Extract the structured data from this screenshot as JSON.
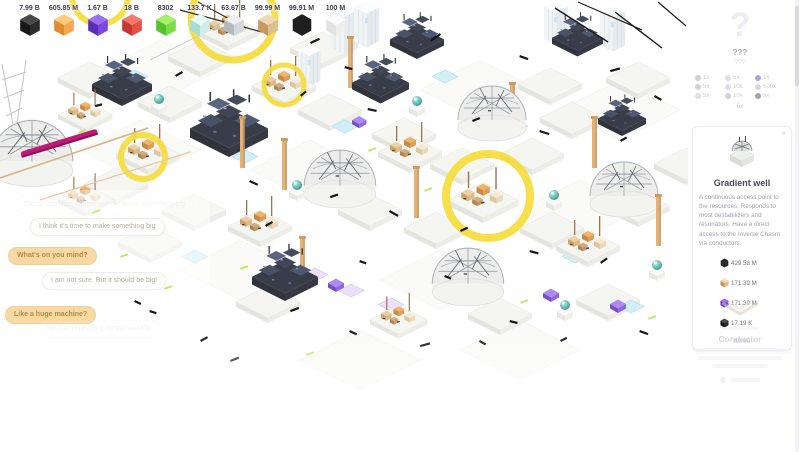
{
  "top_bar": {
    "resources": [
      {
        "name": "black-cube",
        "type": "cube",
        "colors": [
          "#4a4a4a",
          "#181818",
          "#2c2c2c"
        ],
        "value": "7.99 B"
      },
      {
        "name": "orange-cube",
        "type": "cube",
        "colors": [
          "#ffc97e",
          "#e08c2e",
          "#f4a84b"
        ],
        "value": "605.85 M"
      },
      {
        "name": "purple-cube",
        "type": "cube",
        "colors": [
          "#9a6ff5",
          "#5c2eb8",
          "#7a48dd"
        ],
        "value": "1.67 B"
      },
      {
        "name": "red-cube",
        "type": "cube",
        "colors": [
          "#f47a70",
          "#c73832",
          "#e25048"
        ],
        "value": "18 B"
      },
      {
        "name": "green-cube",
        "type": "cube",
        "colors": [
          "#a5f06a",
          "#55c22c",
          "#7cdc48"
        ],
        "value": "8302"
      },
      {
        "name": "prism-cube",
        "type": "cube",
        "colors": [
          "#eafaf7",
          "#a8ded6",
          "#cdeee9"
        ],
        "value": "133.7 K"
      },
      {
        "name": "silver-cube",
        "type": "cube",
        "colors": [
          "#eef0f2",
          "#b4bac0",
          "#d3d7db"
        ],
        "value": "63.67 B"
      },
      {
        "name": "crate-cube",
        "type": "cube",
        "colors": [
          "#eed9b2",
          "#c49a5e",
          "#dcc08b"
        ],
        "value": "99.99 M"
      },
      {
        "name": "black-hexagon",
        "type": "hex",
        "colors": [
          "#1f1f1f"
        ],
        "value": "99.91 M"
      },
      {
        "name": "white-cube",
        "type": "cube",
        "colors": [
          "#fbfbfb",
          "#e2e2e0",
          "#efefec"
        ],
        "value": "100 M"
      }
    ]
  },
  "chat": {
    "bubbles": [
      {
        "speaker": "npc",
        "text": "The possibilities danger remind about something big"
      },
      {
        "speaker": "npc",
        "text": "I think it's time to make something big"
      },
      {
        "speaker": "player",
        "text": "What's on you mind?"
      },
      {
        "speaker": "npc",
        "text": "I am not sure. But it should be big!"
      },
      {
        "speaker": "player",
        "text": "Like a huge machine?"
      },
      {
        "speaker": "npc",
        "text": "No, I am speaking metaphorically."
      }
    ]
  },
  "side_panel": {
    "unknown_item": {
      "glyph": "?",
      "title": "???",
      "subtitle": "???",
      "requirements": [
        {
          "color": "#c6c5d3",
          "value": "1x"
        },
        {
          "color": "#d8d7e2",
          "value": "5x"
        },
        {
          "color": "#9a8ce2",
          "value": "1x"
        },
        {
          "color": "#c6c5d3",
          "value": "5x"
        },
        {
          "color": "#d8d7e2",
          "value": "10x"
        },
        {
          "color": "#cfcede",
          "value": "500x"
        },
        {
          "color": "#d8d7e2",
          "value": "5x"
        },
        {
          "color": "#c6c5d3",
          "value": "10x"
        },
        {
          "color": "#8f8fa0",
          "value": "5x"
        }
      ],
      "footer": "5x"
    },
    "selected_item": {
      "title": "Gradient well",
      "close_label": "×",
      "description": "A continuous access point to the resources. Responds to most destabilizers and resonators. Have a direct access to the Inverse Chasm via conductors.",
      "costs": [
        {
          "name": "black-hexagon",
          "type": "hex",
          "colors": [
            "#2a2a2a"
          ],
          "value": "429.58 M"
        },
        {
          "name": "tan-cube",
          "type": "cube",
          "colors": [
            "#eed9b2",
            "#c49a5e",
            "#dcc08b"
          ],
          "value": "171.39 M"
        },
        {
          "name": "purple-cube",
          "type": "cube",
          "colors": [
            "#9a6ff5",
            "#5c2eb8",
            "#7a48dd"
          ],
          "value": "171.39 M"
        },
        {
          "name": "black-cube",
          "type": "cube",
          "colors": [
            "#4a4a4a",
            "#181818",
            "#2c2c2c"
          ],
          "value": "17.19 K"
        }
      ],
      "count": "80/99"
    },
    "next_item": {
      "title": "Conductor"
    }
  },
  "colors": {
    "highlight_ring": "#f6dc3d",
    "player_bubble": "#f7d9a4",
    "orb_teal": "#55b8ac",
    "magenta_beam": "#c01a78"
  }
}
